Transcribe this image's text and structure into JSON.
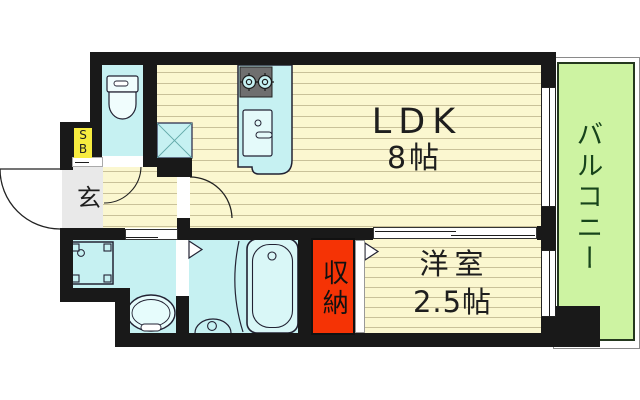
{
  "plan_title": "1K apartment floor plan",
  "rooms": {
    "ldk": {
      "name": "LDK",
      "size": "8帖"
    },
    "western": {
      "name": "洋室",
      "size": "2.5帖"
    },
    "balcony": {
      "name": "バルコニー"
    },
    "storage": {
      "name": "収納"
    },
    "entrance": {
      "name": "玄"
    },
    "shoe_box": {
      "top": "S",
      "bottom": "B"
    }
  },
  "colors": {
    "wall": "#191919",
    "floor": "#FBF7D0",
    "floor_stripe": "#C9C199",
    "wet_area": "#C6F1F2",
    "balcony_green": "#CDF3A2",
    "balcony_text": "#17441B",
    "storage_red": "#F53305",
    "shoe_box_yellow": "#F7EC3F",
    "entrance_gray": "#E9E9E9"
  },
  "icons": {
    "toilet": "toilet-fixture",
    "kitchen": "kitchen-counter-stove-sink",
    "fridge": "refrigerator-space-x",
    "washer": "washing-machine-pan",
    "basin": "wash-basin",
    "bathtub": "bathtub",
    "doors": "swing-and-sliding-door-symbols"
  }
}
